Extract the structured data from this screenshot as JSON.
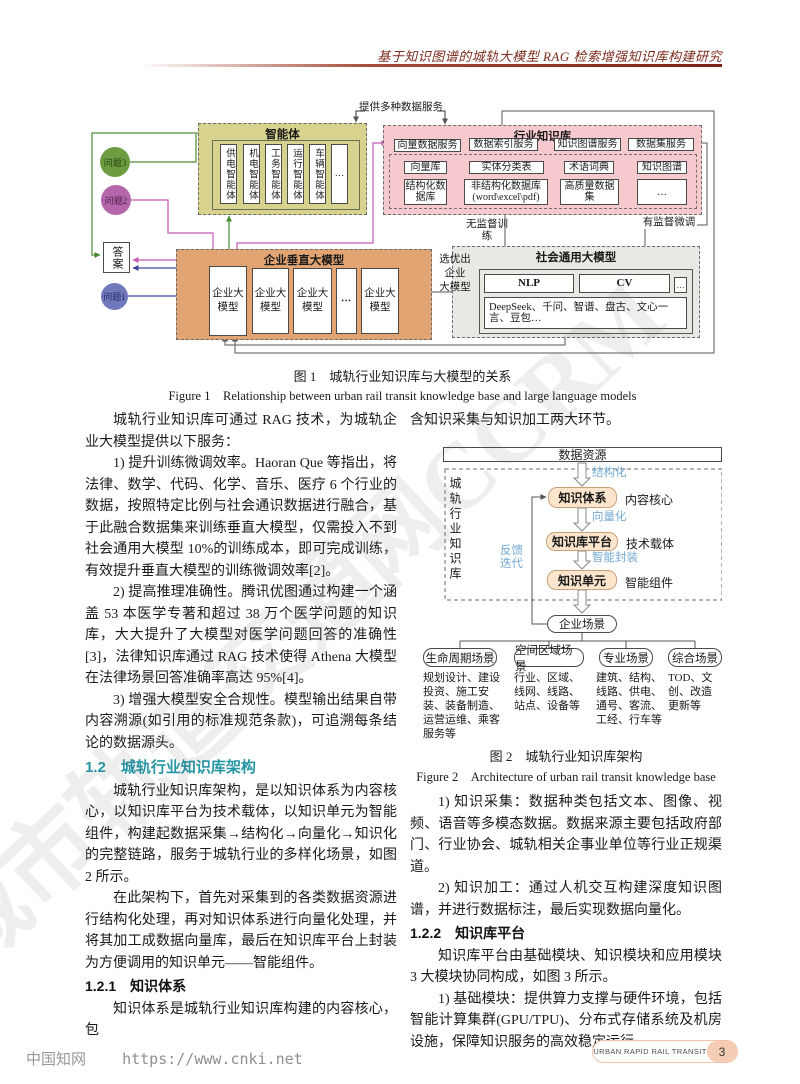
{
  "header": {
    "title": "基于知识图谱的城轨大模型 RAG 检索增强知识库构建研究"
  },
  "watermark": "城市轨道交通网CCRM",
  "fig1": {
    "service_label": "提供多种数据服务",
    "agent_box": {
      "title": "智能体",
      "agents": [
        "供电智能体",
        "机电智能体",
        "工务智能体",
        "运行智能体",
        "车辆智能体",
        "…"
      ]
    },
    "kb_box": {
      "title": "行业知识库",
      "services": [
        "向量数据服务",
        "数据索引服务",
        "知识图谱服务",
        "数据集服务"
      ],
      "row2": [
        "向量库",
        "实体分类表",
        "术语词典",
        "知识图谱"
      ],
      "row3": [
        "结构化数据库",
        "非结构化数据库(word\\excel\\pdf)",
        "高质量数据集",
        "…"
      ]
    },
    "q3": "问题3",
    "q2": "问题2",
    "q1": "问题1",
    "answer": "答案",
    "vertical_box": {
      "title": "企业垂直大模型",
      "model": "企业大模型",
      "dots": "•••"
    },
    "general_box": {
      "title": "社会通用大模型",
      "nlp": "NLP",
      "cv": "CV",
      "dots": "…",
      "models": "DeepSeek、千问、智谱、盘古、文心一言、豆包…"
    },
    "unsupervised": "无监督训练",
    "supervised": "有监督微调",
    "select_lines": [
      "选优出",
      "企业",
      "大模型"
    ]
  },
  "caption1": {
    "zh": "图 1　城轨行业知识库与大模型的关系",
    "en": "Figure 1　Relationship between urban rail transit knowledge base and large language models"
  },
  "left_col": {
    "p1": "城轨行业知识库可通过 RAG 技术，为城轨企业大模型提供以下服务：",
    "p2": "1) 提升训练微调效率。Haoran Que 等指出，将法律、数学、代码、化学、音乐、医疗 6 个行业的数据，按照特定比例与社会通识数据进行融合，基于此融合数据集来训练垂直大模型，仅需投入不到社会通用大模型 10%的训练成本，即可完成训练，有效提升垂直大模型的训练微调效率[2]。",
    "p3": "2) 提高推理准确性。腾讯优图通过构建一个涵盖 53 本医学专著和超过 38 万个医学问题的知识库，大大提升了大模型对医学问题回答的准确性[3]，法律知识库通过 RAG 技术使得 Athena 大模型在法律场景回答准确率高达 95%[4]。",
    "p4": "3) 增强大模型安全合规性。模型输出结果自带内容溯源(如引用的标准规范条款)，可追溯每条结论的数据源头。",
    "h12": "1.2　城轨行业知识库架构",
    "p5": "城轨行业知识库架构，是以知识体系为内容核心，以知识库平台为技术载体，以知识单元为智能组件，构建起数据采集→结构化→向量化→知识化的完整链路，服务于城轨行业的多样化场景，如图 2 所示。",
    "p6": "在此架构下，首先对采集到的各类数据资源进行结构化处理，再对知识体系进行向量化处理，并将其加工成数据向量库，最后在知识库平台上封装为方便调用的知识单元——智能组件。",
    "h121": "1.2.1　知识体系",
    "p7": "知识体系是城轨行业知识库构建的内容核心，包"
  },
  "fig2": {
    "data_source": "数据资源",
    "side_label": "城轨行业知识库",
    "feedback": "反馈迭代",
    "steps": {
      "structure": "结构化",
      "vector": "向量化",
      "encapsulate": "智能封装"
    },
    "nodes": [
      {
        "name": "知识体系",
        "role": "内容核心"
      },
      {
        "name": "知识库平台",
        "role": "技术载体"
      },
      {
        "name": "知识单元",
        "role": "智能组件"
      }
    ],
    "scene": "企业场景",
    "scenarios": [
      {
        "title": "生命周期场景",
        "items": "规划设计、建设投资、施工安装、装备制造、运营运维、乘客服务等"
      },
      {
        "title": "空间区域场景",
        "items": "行业、区域、线网、线路、站点、设备等"
      },
      {
        "title": "专业场景",
        "items": "建筑、结构、线路、供电、通号、客流、工经、行车等"
      },
      {
        "title": "综合场景",
        "items": "TOD、文创、改造更新等"
      }
    ]
  },
  "caption2": {
    "zh": "图 2　城轨行业知识库架构",
    "en": "Figure 2　Architecture of urban rail transit knowledge base"
  },
  "right_col": {
    "p0": "含知识采集与知识加工两大环节。",
    "p1": "1) 知识采集：数据种类包括文本、图像、视频、语音等多模态数据。数据来源主要包括政府部门、行业协会、城轨相关企事业单位等行业正规渠道。",
    "p2": "2) 知识加工：通过人机交互构建深度知识图谱，并进行数据标注，最后实现数据向量化。",
    "h122": "1.2.2　知识库平台",
    "p3": "知识库平台由基础模块、知识模块和应用模块 3 大模块协同构成，如图 3 所示。",
    "p4": "1) 基础模块：提供算力支撑与硬件环境，包括智能计算集群(GPU/TPU)、分布式存储系统及机房设施，保障知识服务的高效稳定运行。"
  },
  "footer": {
    "cnki": "中国知网",
    "url": "https://www.cnki.net",
    "journal": "URBAN RAPID RAIL TRANSIT",
    "page": "3"
  }
}
